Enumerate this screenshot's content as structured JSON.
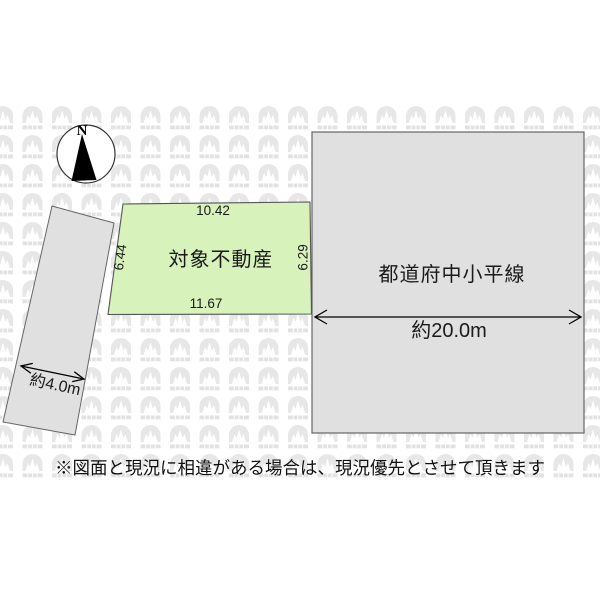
{
  "compass": {
    "north_label": "N"
  },
  "plot": {
    "name": "対象不動産",
    "dim_top": "10.42",
    "dim_bottom": "11.67",
    "dim_left": "6.44",
    "dim_right": "6.29",
    "fill": "#d7f2ba"
  },
  "road_main": {
    "name": "都道府中小平線",
    "width_label": "約20.0m",
    "fill": "#e0e0e0"
  },
  "road_side": {
    "width_label": "約4.0m",
    "fill": "#e0e0e0"
  },
  "disclaimer": "※図面と現況に相違がある場合は、現況優先とさせて頂きます",
  "colors": {
    "outline": "#555555",
    "arrow": "#000000",
    "watermark_tile": "#e7e7e7",
    "watermark_strip": "#e2e2e2"
  }
}
